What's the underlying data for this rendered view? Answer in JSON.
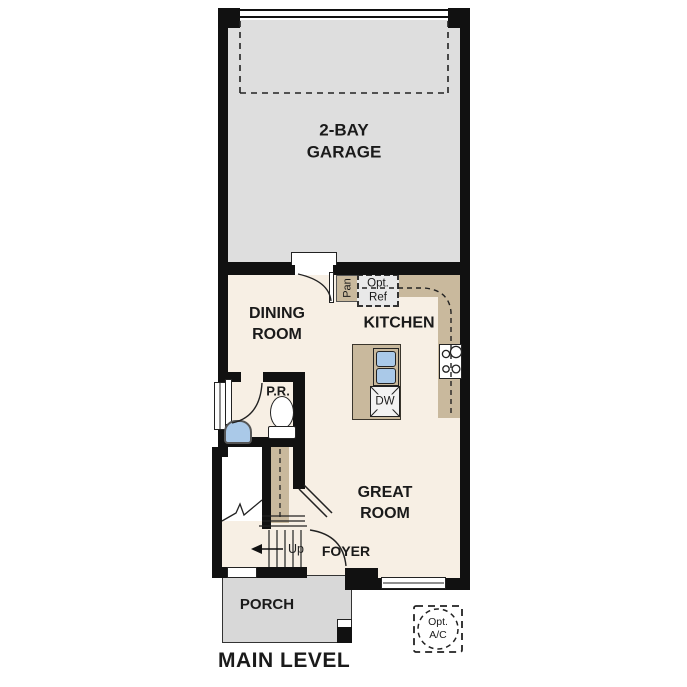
{
  "plan_title": "MAIN LEVEL",
  "rooms": {
    "garage": {
      "label": "2-BAY\nGARAGE"
    },
    "dining": {
      "label": "DINING\nROOM"
    },
    "kitchen": {
      "label": "KITCHEN"
    },
    "great_room": {
      "label": "GREAT\nROOM"
    },
    "powder_room": {
      "label": "P.R."
    },
    "foyer": {
      "label": "FOYER"
    },
    "porch": {
      "label": "PORCH"
    }
  },
  "annotations": {
    "stairs_direction": "Up",
    "pantry": "Pan",
    "optional_refrigerator": "Opt.\nRef",
    "dishwasher": "DW",
    "optional_ac": "Opt.\nA/C"
  },
  "colors": {
    "wall": "#111111",
    "garage_floor": "#dedede",
    "interior_floor": "#f7efe4",
    "porch_floor": "#d8d8d8",
    "cabinetry_tan": "#c9b99d",
    "fixture_blue": "#aac9e8",
    "optional_box_fill": "#e9e9e9"
  }
}
